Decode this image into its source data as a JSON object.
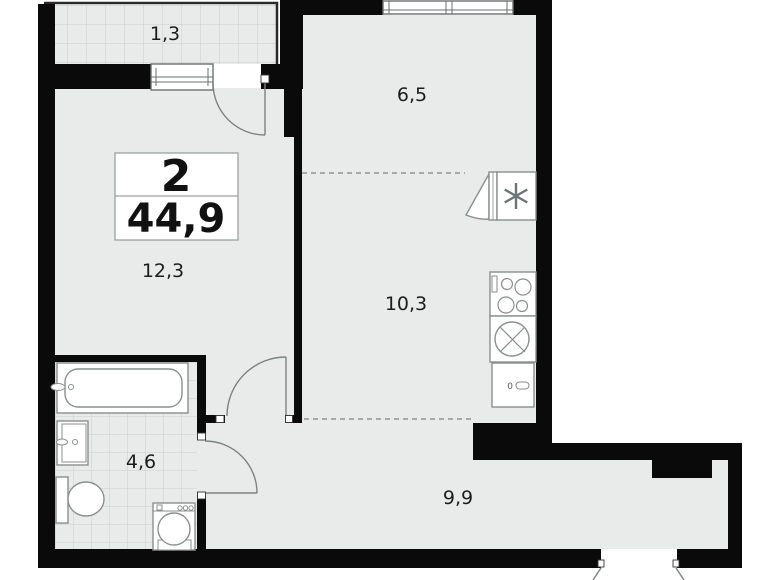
{
  "floorplan": {
    "summary": {
      "rooms_count": "2",
      "total_area": "44,9"
    },
    "room_labels": {
      "balcony": "1,3",
      "bedroom": "6,5",
      "living": "12,3",
      "kitchen": "10,3",
      "bathroom": "4,6",
      "hallway": "9,9"
    },
    "fixtures": {
      "cabinet_label": "0"
    },
    "colors": {
      "wall": "#0a0a0a",
      "floor": "#e9ebea",
      "tile_line": "#c9cdcc",
      "fixture_outline": "#8a8f8e",
      "door_arc": "#7b8383",
      "dash_line": "#8f9695",
      "text": "#1c1c1c"
    }
  }
}
